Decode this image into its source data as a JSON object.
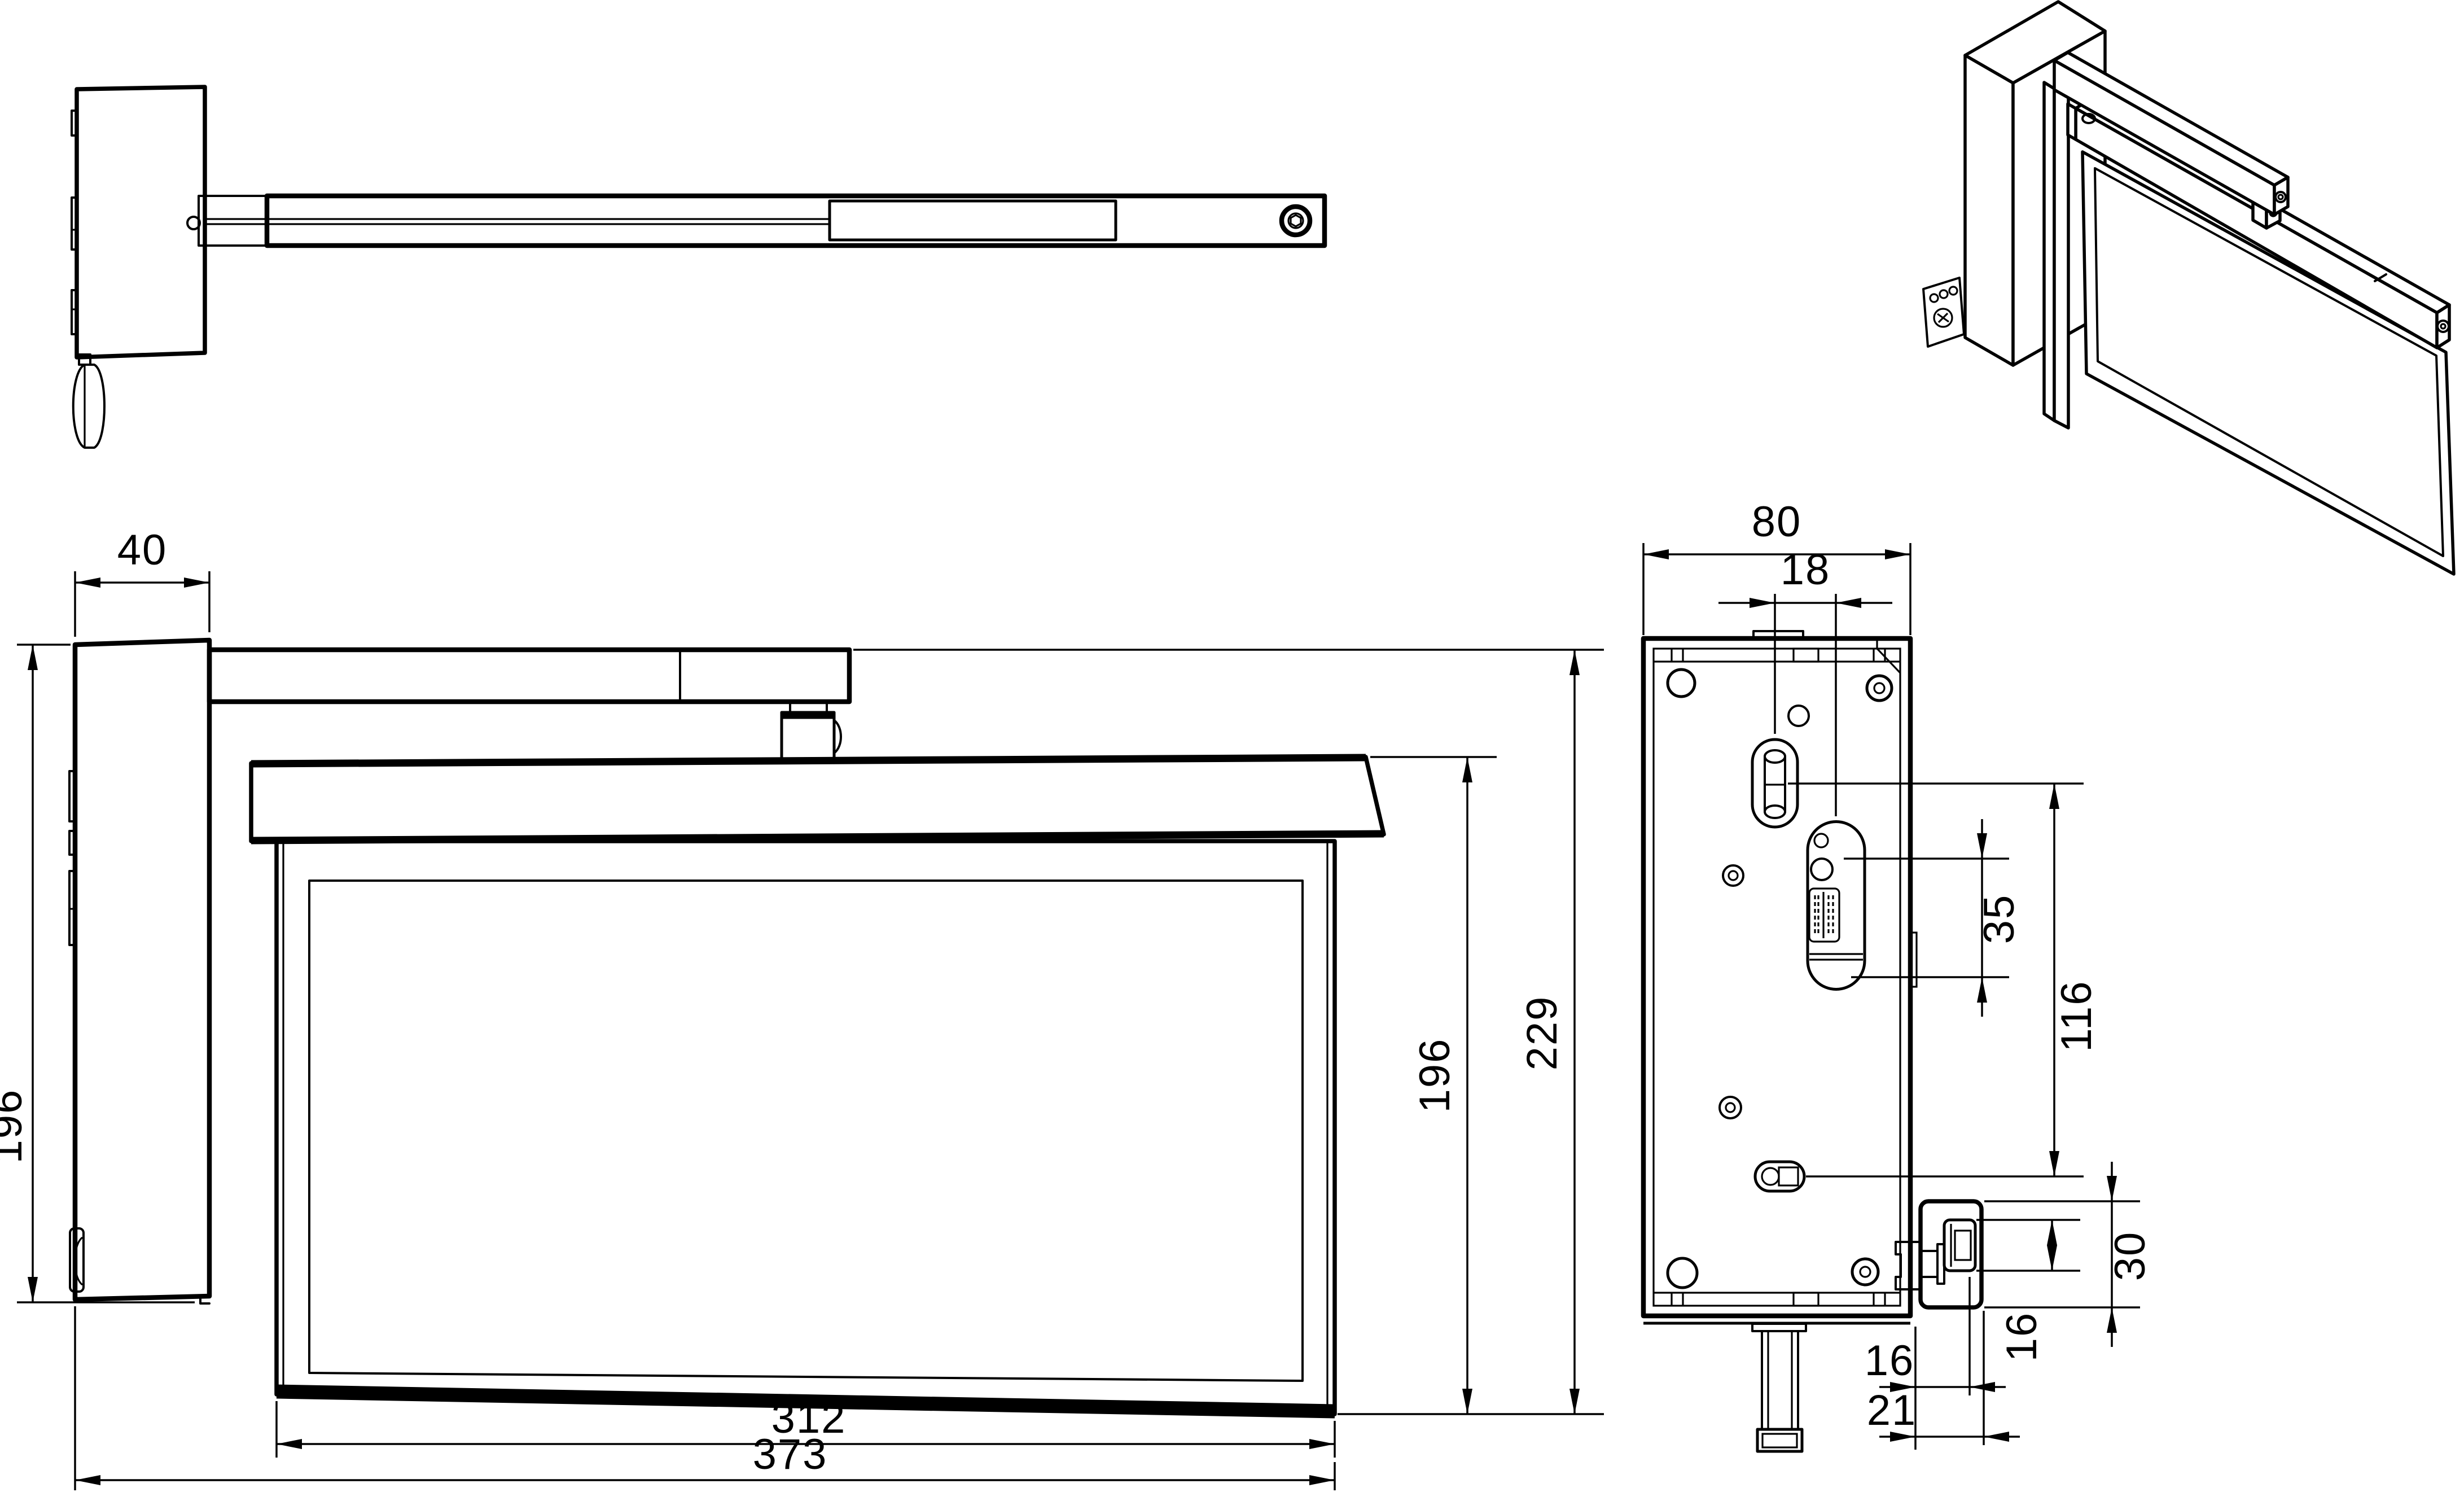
{
  "dimensions": {
    "front": {
      "bracket_depth": "40",
      "bracket_height": "196",
      "panel_width": "312",
      "overall_width": "373",
      "panel_height": "196",
      "overall_height": "229"
    },
    "back": {
      "plate_width": "80",
      "pin_offset": "18",
      "slot_span": "35",
      "pin_spacing": "116",
      "hinge_height": "30",
      "bolt_span": "16",
      "pivot_offset": "16",
      "block_offset": "21"
    }
  }
}
